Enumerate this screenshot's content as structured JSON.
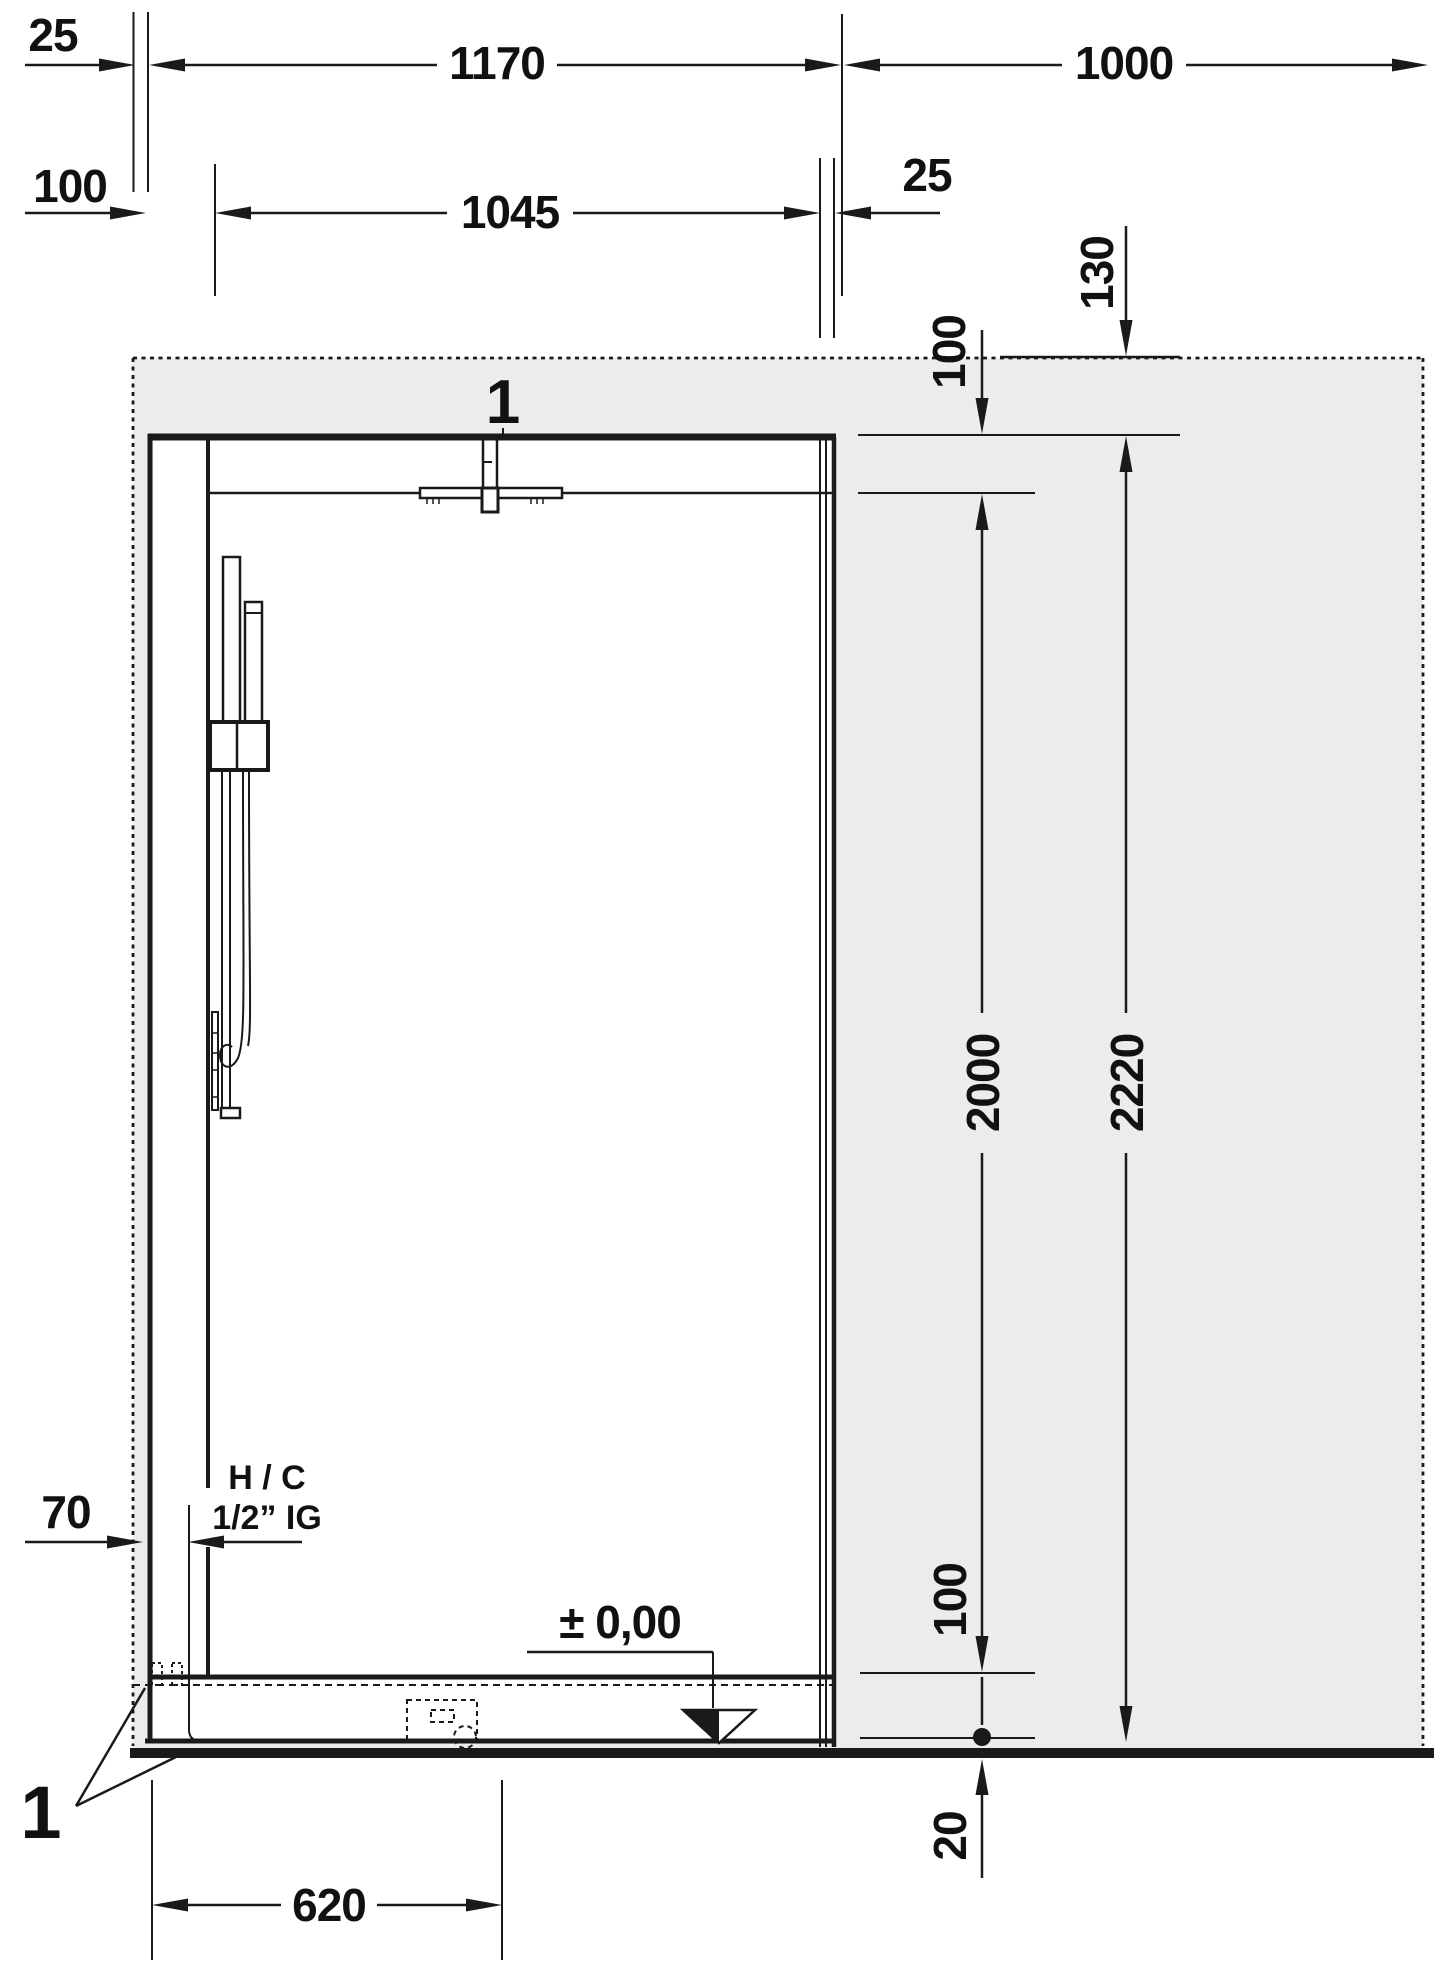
{
  "dimensions": {
    "wall_thickness_top": "25",
    "opening_width": "1170",
    "side_wall_width": "1000",
    "left_profile_offset": "100",
    "glass_width": "1045",
    "door_wall_gap": "25",
    "top_clearance": "130",
    "top_profile_height": "100",
    "supply_offset": "70",
    "door_glass_height": "2000",
    "total_height": "2220",
    "base_clearance": "100",
    "floor_buildup": "20",
    "drain_offset": "620"
  },
  "callouts": {
    "panel_top": "1",
    "tray_corner": "1"
  },
  "labels": {
    "water_supply_line1": "H / C",
    "water_supply_line2": "1/2” IG",
    "floor_level": "± 0,00"
  },
  "colors": {
    "wall_fill": "#ececec",
    "line": "#1a1a1a",
    "background": "#ffffff"
  }
}
